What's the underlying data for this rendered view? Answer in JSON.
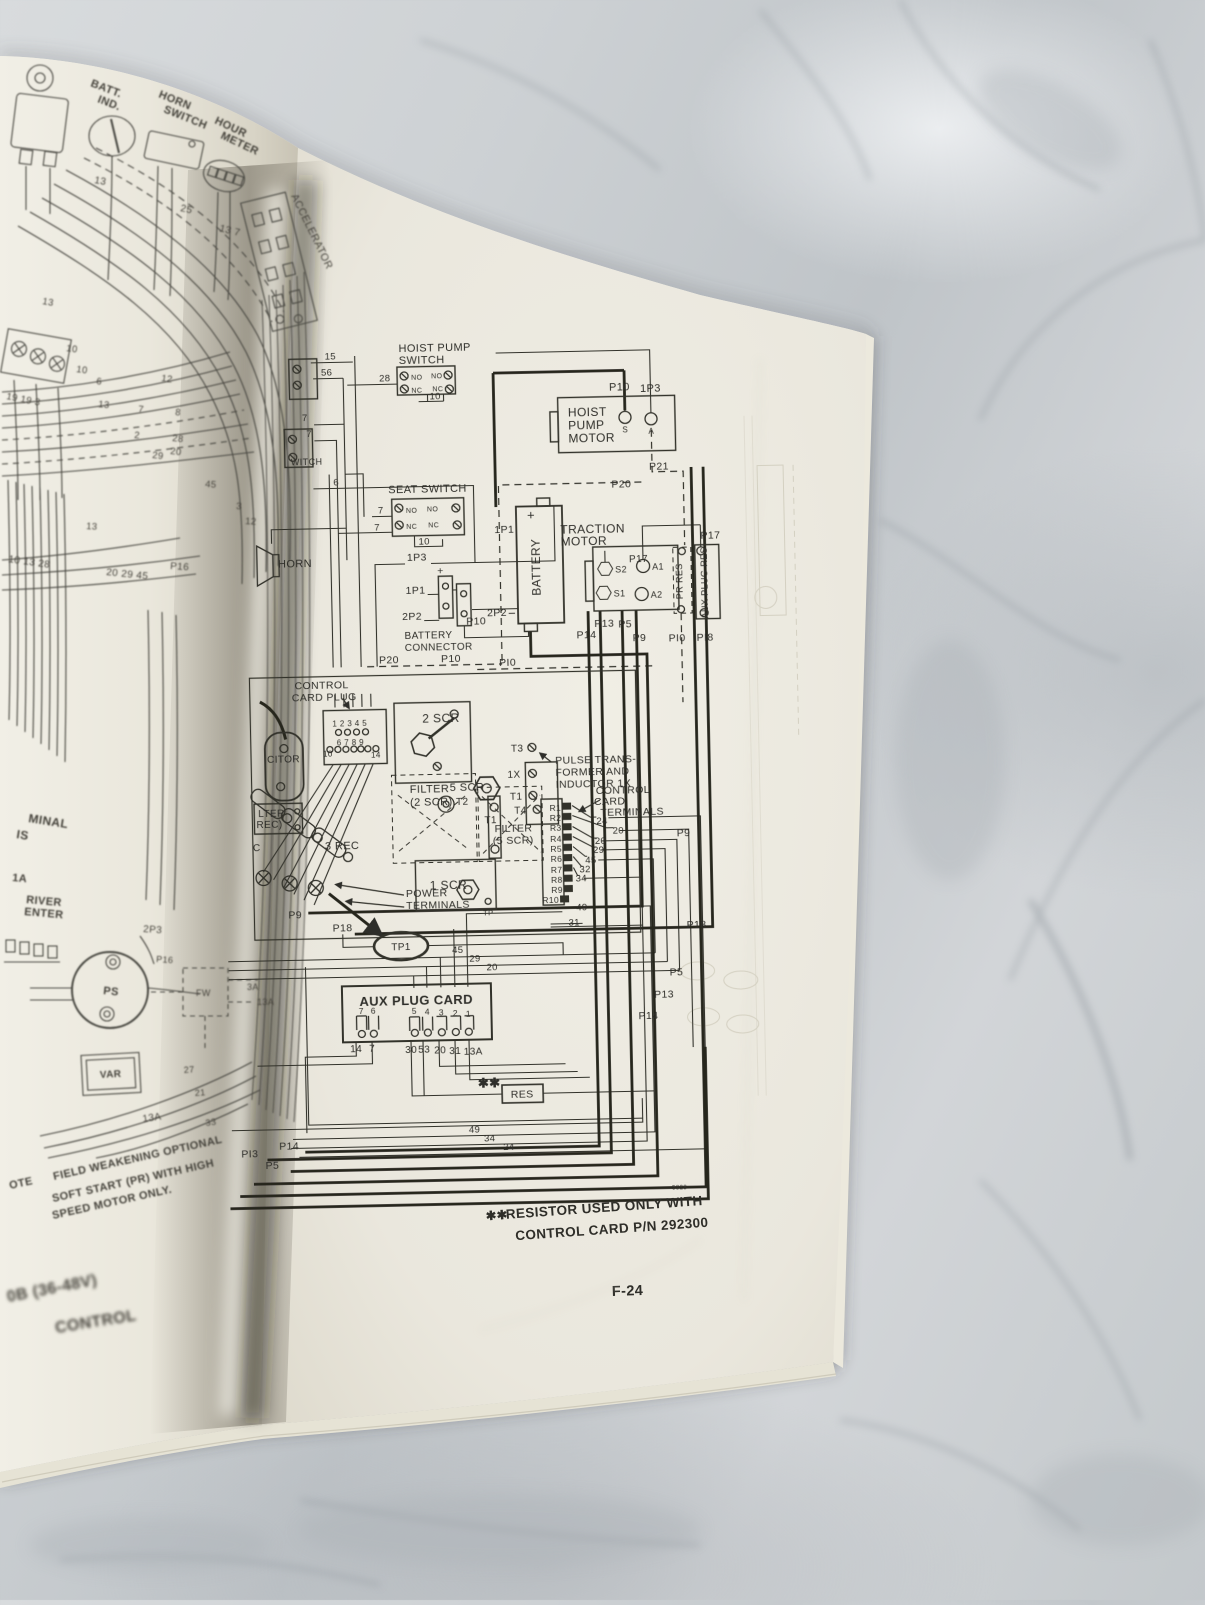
{
  "photo": {
    "colors": {
      "marble_light": "#d7dadc",
      "marble_dark": "#a6acb1",
      "page": "#edeae0",
      "ink": "#2f2e29"
    }
  },
  "footer": {
    "page_number": "F-24",
    "figure_number": "5828"
  },
  "footnote": {
    "marker": "✱✱",
    "line1": "RESISTOR USED ONLY WITH",
    "line2": "CONTROL CARD P/N 292300"
  },
  "right_page": {
    "hoist_pump_switch": {
      "title1": "HOIST PUMP",
      "title2": "SWITCH",
      "no": "NO",
      "nc": "NC",
      "w15": "15",
      "w56": "56",
      "w28": "28",
      "w10": "10"
    },
    "seat_switch": {
      "title": "SEAT SWITCH",
      "no": "NO",
      "nc": "NC",
      "w7": "7",
      "w10": "10"
    },
    "spine_switch": {
      "label": "WITCH",
      "w7": "7",
      "w6": "6"
    },
    "horn": "HORN",
    "hoist_pump_motor": {
      "l1": "HOIST",
      "l2": "PUMP",
      "l3": "MOTOR",
      "s": "S",
      "a": "A"
    },
    "battery": {
      "label": "BATTERY",
      "plus": "+",
      "minus": "−"
    },
    "battery_connector": {
      "l1": "BATTERY",
      "l2": "CONNECTOR",
      "plus": "+"
    },
    "traction_motor": {
      "l1": "TRACTION",
      "l2": "MOTOR",
      "s1": "S1",
      "s2": "S2",
      "a1": "A1",
      "a2": "A2"
    },
    "pr_res": "PR RES",
    "aux_plug_res": "AUX PLUG RES",
    "tags": {
      "p5": "P5",
      "p9": "P9",
      "p10": "P10",
      "pi0": "PI0",
      "p13": "P13",
      "pi3": "PI3",
      "p14": "P14",
      "p17": "P17",
      "p18": "P18",
      "pi8": "PI8",
      "p20": "P20",
      "p21": "P21",
      "c1p1": "1P1",
      "c1p3": "1P3",
      "c2p2": "2P2"
    },
    "control_card_plug": {
      "l1": "CONTROL",
      "l2": "CARD PLUG",
      "row1": "1 2 3 4 5",
      "row2": "6 7 8 9",
      "n10": "10",
      "n14": "14"
    },
    "scr": {
      "scr2": "2 SCR",
      "scr5": "5 SCR",
      "scr1": "1 SCR",
      "rec3": "3 REC",
      "tp": "TP",
      "tp1": "TP1"
    },
    "filters": {
      "filter": "FILTER",
      "f2": "(2 SCR)",
      "f5": "(5 SCR)",
      "cap": "CITOR",
      "flt": "LTER",
      "rec": "REC)",
      "c": "C"
    },
    "pulse": {
      "l1": "PULSE TRANS-",
      "l2": "FORMER AND",
      "l3": "INDUCTOR 1X",
      "t1": "T1",
      "t2": "T2",
      "t3": "T3",
      "t4": "T4",
      "x1": "1X"
    },
    "card_terminals": {
      "l1": "CONTROL",
      "l2": "CARD",
      "l3": "TERMINALS",
      "r": [
        "R1",
        "R2",
        "R3",
        "R4",
        "R5",
        "R6",
        "R7",
        "R8",
        "R9",
        "R10"
      ],
      "w": [
        "24",
        "20",
        "20",
        "29",
        "45",
        "32",
        "34",
        "49",
        "31"
      ]
    },
    "power_terminals": {
      "l1": "POWER",
      "l2": "TERMINALS"
    },
    "aux_plug_card": {
      "title": "AUX PLUG CARD",
      "pins_top": [
        "7",
        "6",
        "5",
        "4",
        "3",
        "2",
        "1"
      ],
      "pins_bottom": [
        "14",
        "7",
        "30",
        "53",
        "20",
        "31",
        "13A"
      ],
      "res": "RES",
      "stars": "✱✱"
    },
    "wires": {
      "w45": "45",
      "w29": "29",
      "w20": "20",
      "w49": "49",
      "w34": "34",
      "w24": "24",
      "w31": "31"
    }
  },
  "left_page": {
    "batt_ind": {
      "l1": "BATT.",
      "l2": "IND."
    },
    "horn_switch": {
      "l1": "HORN",
      "l2": "SWITCH"
    },
    "hour_meter": {
      "l1": "HOUR",
      "l2": "METER"
    },
    "accelerator": "ACCELERATOR",
    "terminal": {
      "l1": "MINAL",
      "l2": "IS"
    },
    "driver": {
      "l1": "1A",
      "l2": "RIVER",
      "l3": "ENTER"
    },
    "ps": "PS",
    "fw": "FW",
    "var": "VAR",
    "tags": {
      "t2p3": "2P3",
      "p16": "P16"
    },
    "nums": {
      "n2": "2",
      "n3": "3",
      "n6": "6",
      "n7": "7",
      "n8": "8",
      "n10": "10",
      "n12": "12",
      "n13": "13",
      "n20": "20",
      "n21": "21",
      "n25": "25",
      "n27": "27",
      "n28": "28",
      "n29": "29",
      "n33": "33",
      "n45": "45",
      "n137": "13 7",
      "n19193": "19 19 3",
      "n101328": "10 13 28",
      "n202945": "20 29 45",
      "n13a": "13A",
      "n3a": "3A"
    },
    "note": {
      "prefix": "OTE",
      "l1": "FIELD WEAKENING OPTIONAL",
      "l2": "SOFT START (PR) WITH HIGH",
      "l3": "SPEED MOTOR ONLY."
    },
    "model": {
      "l1": "0B (36-48V)",
      "l2": "CONTROL"
    }
  }
}
